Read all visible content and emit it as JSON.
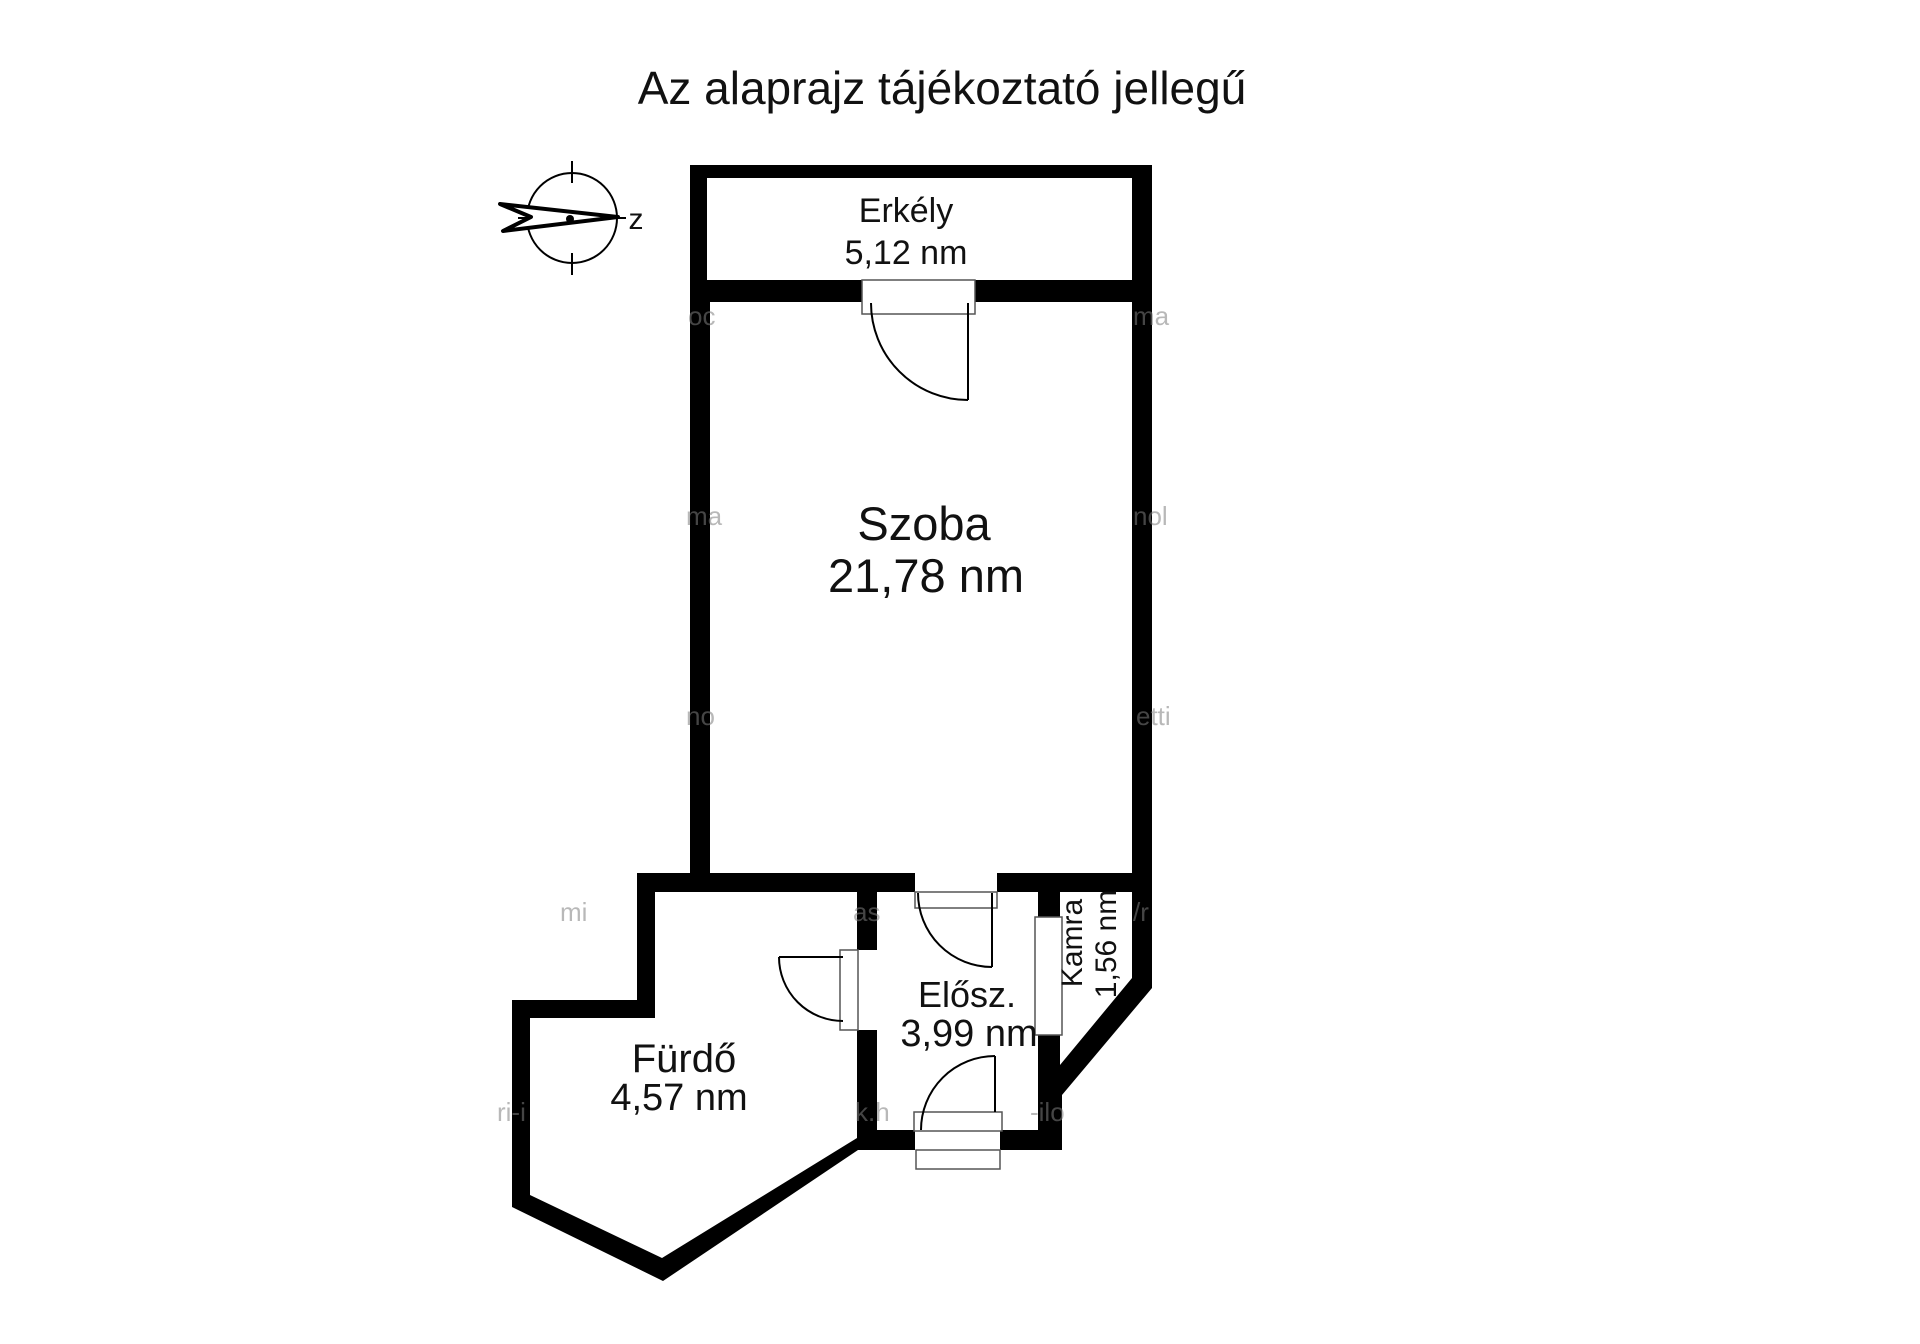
{
  "title": "Az alaprajz tájékoztató jellegű",
  "compass": {
    "label": "z"
  },
  "rooms": {
    "erkely": {
      "name": "Erkély",
      "area": "5,12 nm"
    },
    "szoba": {
      "name": "Szoba",
      "area": "21,78 nm"
    },
    "furdo": {
      "name": "Fürdő",
      "area": "4,57 nm"
    },
    "elosz": {
      "name": "Elősz.",
      "area": "3,99 nm"
    },
    "kamra": {
      "name": "Kamra",
      "area": "1,56 nm"
    }
  },
  "watermarks": [
    "oc",
    "ma",
    "ma",
    "nol",
    "no",
    "etti",
    "mi",
    "as",
    "/r",
    "ri-i",
    "k.h",
    "-ilo"
  ],
  "colors": {
    "wall": "#000000",
    "background": "#ffffff",
    "text": "#111111",
    "thin_line": "#555555",
    "watermark": "#7f7f7f"
  }
}
